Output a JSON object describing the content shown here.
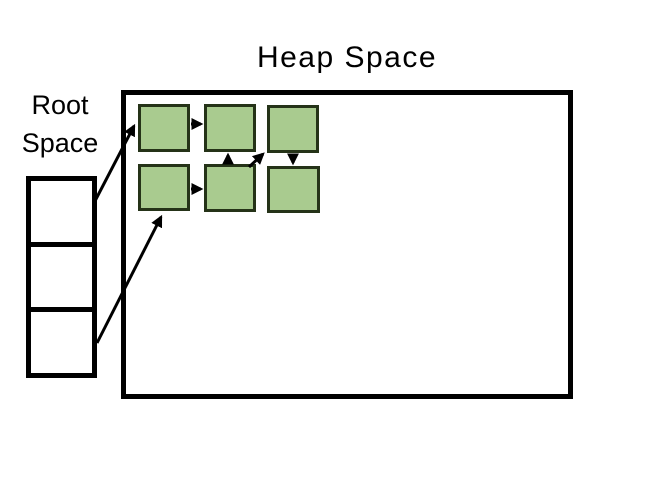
{
  "heap": {
    "title": "Heap Space"
  },
  "root": {
    "label": "Root Space",
    "cell_count": 3
  },
  "colors": {
    "object_fill": "#a9cb8f",
    "object_border": "#253318",
    "outline": "#000000",
    "background": "#ffffff"
  },
  "diagram": {
    "heap_objects": [
      {
        "name": "heap-object-1",
        "x": 138,
        "y": 104,
        "w": 52,
        "h": 48
      },
      {
        "name": "heap-object-2",
        "x": 204,
        "y": 104,
        "w": 52,
        "h": 48
      },
      {
        "name": "heap-object-3",
        "x": 267,
        "y": 105,
        "w": 52,
        "h": 48
      },
      {
        "name": "heap-object-4",
        "x": 138,
        "y": 164,
        "w": 52,
        "h": 47
      },
      {
        "name": "heap-object-5",
        "x": 204,
        "y": 164,
        "w": 52,
        "h": 48
      },
      {
        "name": "heap-object-6",
        "x": 267,
        "y": 166,
        "w": 53,
        "h": 47
      }
    ],
    "arrows": [
      {
        "name": "ref-root-cell-1-to-object-1",
        "x1": 95,
        "y1": 201,
        "x2": 134,
        "y2": 126
      },
      {
        "name": "ref-root-cell-3-to-object-4",
        "x1": 97,
        "y1": 343,
        "x2": 161,
        "y2": 217
      },
      {
        "name": "ref-object-1-to-object-2",
        "x1": 191,
        "y1": 124,
        "x2": 201,
        "y2": 124
      },
      {
        "name": "ref-object-4-to-object-5",
        "x1": 191,
        "y1": 189,
        "x2": 201,
        "y2": 189
      },
      {
        "name": "ref-object-5-to-object-2",
        "x1": 228,
        "y1": 164,
        "x2": 228,
        "y2": 155
      },
      {
        "name": "ref-object-5-to-object-3",
        "x1": 249,
        "y1": 167,
        "x2": 263,
        "y2": 154
      },
      {
        "name": "ref-object-3-to-object-6",
        "x1": 293,
        "y1": 155,
        "x2": 293,
        "y2": 163
      }
    ]
  }
}
